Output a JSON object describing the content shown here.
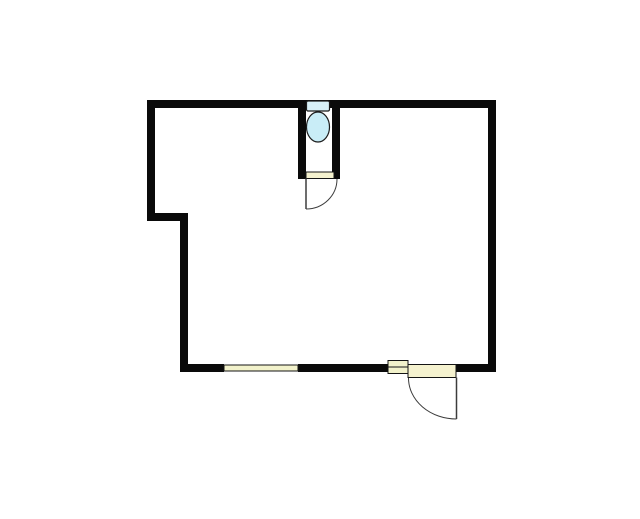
{
  "page": {
    "background": "#ffffff"
  },
  "floor_plan": {
    "canvas": {
      "width": 640,
      "height": 519
    },
    "colors": {
      "background": "#ffffff",
      "wall": "#0a0a0a",
      "outline": "#141414",
      "swing": "#3c3c3c",
      "window_fill": "#f2f2cb",
      "door_fill": "#f5f2cf",
      "fixture_tank_fill": "#d8f1f8",
      "fixture_bowl_fill": "#c9edf7",
      "fixture_outline": "#1c1c1c"
    },
    "elements": [
      {
        "name": "wall-top",
        "kind": "rect",
        "interactable": false,
        "x": 147,
        "y": 100,
        "w": 349,
        "h": 8,
        "fill": "wall"
      },
      {
        "name": "wall-right",
        "kind": "rect",
        "interactable": false,
        "x": 488,
        "y": 100,
        "w": 8,
        "h": 272,
        "fill": "wall"
      },
      {
        "name": "wall-left-upper",
        "kind": "rect",
        "interactable": false,
        "x": 147,
        "y": 100,
        "w": 8,
        "h": 121,
        "fill": "wall"
      },
      {
        "name": "wall-step",
        "kind": "rect",
        "interactable": false,
        "x": 147,
        "y": 213,
        "w": 41,
        "h": 8,
        "fill": "wall"
      },
      {
        "name": "wall-left-lower",
        "kind": "rect",
        "interactable": false,
        "x": 180,
        "y": 213,
        "w": 8,
        "h": 159,
        "fill": "wall"
      },
      {
        "name": "wall-bottom-left",
        "kind": "rect",
        "interactable": false,
        "x": 180,
        "y": 364,
        "w": 44,
        "h": 8,
        "fill": "wall"
      },
      {
        "name": "wall-bottom-middle",
        "kind": "rect",
        "interactable": false,
        "x": 298,
        "y": 364,
        "w": 90,
        "h": 8,
        "fill": "wall"
      },
      {
        "name": "wall-bottom-right",
        "kind": "rect",
        "interactable": false,
        "x": 456,
        "y": 364,
        "w": 40,
        "h": 8,
        "fill": "wall"
      },
      {
        "name": "wc-wall-left",
        "kind": "rect",
        "interactable": false,
        "x": 298,
        "y": 108,
        "w": 8,
        "h": 71,
        "fill": "wall"
      },
      {
        "name": "wc-wall-right",
        "kind": "rect",
        "interactable": false,
        "x": 332,
        "y": 108,
        "w": 8,
        "h": 71,
        "fill": "wall"
      },
      {
        "name": "window-bottom",
        "kind": "rect",
        "interactable": false,
        "x": 224,
        "y": 365,
        "w": 74,
        "h": 6,
        "fill": "window_fill",
        "stroke": "outline",
        "strokeWidth": 1
      },
      {
        "name": "window-side",
        "kind": "rect",
        "interactable": false,
        "x": 388,
        "y": 360.5,
        "w": 20,
        "h": 13,
        "fill": "window_fill",
        "stroke": "outline",
        "strokeWidth": 1
      },
      {
        "name": "window-side-mullion",
        "kind": "line",
        "interactable": false,
        "x1": 388,
        "y1": 367,
        "x2": 408,
        "y2": 367,
        "stroke": "outline",
        "strokeWidth": 1
      },
      {
        "name": "wc-door-sill",
        "kind": "rect",
        "interactable": false,
        "x": 306,
        "y": 172,
        "w": 28,
        "h": 6.5,
        "fill": "door_fill",
        "stroke": "outline",
        "strokeWidth": 1
      },
      {
        "name": "wc-door-swing-arc",
        "kind": "path",
        "interactable": false,
        "d": "M 306 209 A 31 30 0 0 0 337 179",
        "stroke": "swing",
        "strokeWidth": 1,
        "fill": "none"
      },
      {
        "name": "wc-door-leaf",
        "kind": "line",
        "interactable": false,
        "x1": 306,
        "y1": 178.5,
        "x2": 306,
        "y2": 209,
        "stroke": "swing",
        "strokeWidth": 1.5
      },
      {
        "name": "entry-door-threshold",
        "kind": "rect",
        "interactable": false,
        "x": 408,
        "y": 364.5,
        "w": 48,
        "h": 13,
        "fill": "door_fill",
        "stroke": "outline",
        "strokeWidth": 1
      },
      {
        "name": "entry-door-swing-arc",
        "kind": "path",
        "interactable": false,
        "d": "M 408.5 378 A 48 41 0 0 0 456.5 419",
        "stroke": "swing",
        "strokeWidth": 1,
        "fill": "none"
      },
      {
        "name": "entry-door-leaf",
        "kind": "line",
        "interactable": false,
        "x1": 456.5,
        "y1": 377.5,
        "x2": 456.5,
        "y2": 419,
        "stroke": "swing",
        "strokeWidth": 1.5
      },
      {
        "name": "toilet-tank",
        "kind": "rect",
        "interactable": false,
        "x": 306.5,
        "y": 101,
        "w": 23,
        "h": 10,
        "rx": 1.5,
        "fill": "fixture_tank_fill",
        "stroke": "fixture_outline",
        "strokeWidth": 1.2
      },
      {
        "name": "toilet-bowl",
        "kind": "ellipse",
        "interactable": false,
        "cx": 318,
        "cy": 127,
        "rx": 11.5,
        "ry": 15,
        "fill": "fixture_bowl_fill",
        "stroke": "fixture_outline",
        "strokeWidth": 1.2
      }
    ]
  }
}
